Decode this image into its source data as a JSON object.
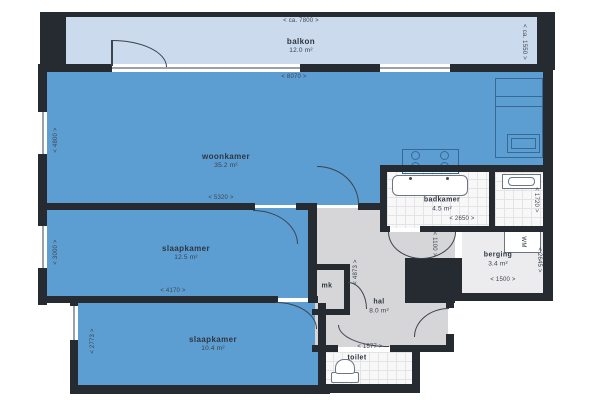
{
  "rooms": {
    "balkon": {
      "name": "balkon",
      "area": "12.0 m²"
    },
    "woonkamer": {
      "name": "woonkamer",
      "area": "35.2 m²"
    },
    "slaapkamer1": {
      "name": "slaapkamer",
      "area": "12.5 m²"
    },
    "slaapkamer2": {
      "name": "slaapkamer",
      "area": "10.4 m²"
    },
    "badkamer": {
      "name": "badkamer",
      "area": "4.5 m²"
    },
    "berging": {
      "name": "berging",
      "area": "3.4 m²"
    },
    "hal": {
      "name": "hal",
      "area": "8.0 m²"
    },
    "toilet": {
      "name": "toilet"
    },
    "mk": {
      "name": "mk"
    }
  },
  "dims": {
    "d7800": "< ca. 7800 >",
    "d1550": "< ca. 1550 >",
    "d8070": "< 8070 >",
    "d4800": "< 4800 >",
    "d5320": "< 5320 >",
    "d3000": "< 3000 >",
    "d4170": "< 4170 >",
    "d2773": "< 2773 >",
    "d2650": "< 2650 >",
    "d1720": "< 1720 >",
    "d2645": "< 2645 >",
    "d1500": "< 1500 >",
    "d4873": "< 4873 >",
    "d1100": "< 1100 >",
    "d1577": "< 1577 >"
  },
  "appliances": {
    "wm": "WM"
  },
  "colors": {
    "room_blue": "#5d9ed2",
    "balcony_blue": "#cbdaec",
    "wall_black": "#262b32",
    "hall_gray": "#d6d6d8",
    "tile_white": "#f8f8f9",
    "storage_gray": "#ececee"
  }
}
